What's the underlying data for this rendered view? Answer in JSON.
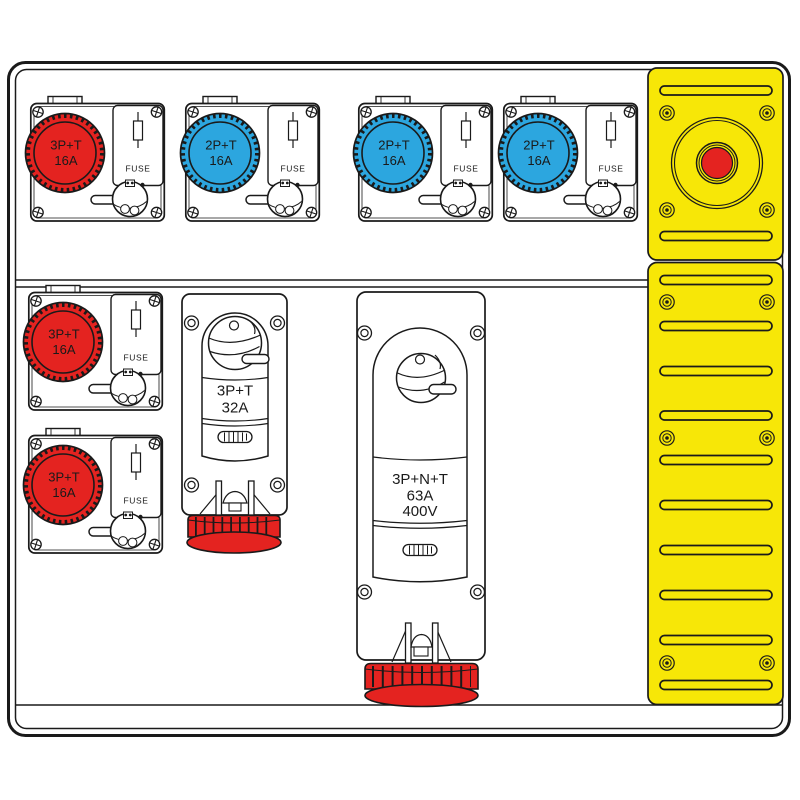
{
  "colors": {
    "socket_red": "#E42320",
    "socket_blue": "#2CA6DF",
    "panel_yellow": "#F7E707",
    "outline": "#1A1A1A",
    "background": "#FFFFFF"
  },
  "fuse_socket_units": [
    {
      "position": "top-row-1",
      "color": "red",
      "label_top": "3P+T",
      "label_bottom": "16A",
      "fuse_label": "FUSE"
    },
    {
      "position": "top-row-2",
      "color": "blue",
      "label_top": "2P+T",
      "label_bottom": "16A",
      "fuse_label": "FUSE"
    },
    {
      "position": "top-row-3",
      "color": "blue",
      "label_top": "2P+T",
      "label_bottom": "16A",
      "fuse_label": "FUSE"
    },
    {
      "position": "top-row-4",
      "color": "blue",
      "label_top": "2P+T",
      "label_bottom": "16A",
      "fuse_label": "FUSE"
    },
    {
      "position": "left-col-1",
      "color": "red",
      "label_top": "3P+T",
      "label_bottom": "16A",
      "fuse_label": "FUSE"
    },
    {
      "position": "left-col-2",
      "color": "red",
      "label_top": "3P+T",
      "label_bottom": "16A",
      "fuse_label": "FUSE"
    }
  ],
  "interlocked_units": [
    {
      "line1": "3P+T",
      "line2": "32A",
      "cap_color": "red"
    },
    {
      "line1": "3P+N+T",
      "line2": "63A",
      "line3": "400V",
      "cap_color": "red"
    }
  ],
  "emergency_panel": {
    "button_color": "#E42320",
    "panel_color": "#F7E707",
    "top_slots": 2,
    "bottom_slots": 10,
    "screws": 10
  }
}
